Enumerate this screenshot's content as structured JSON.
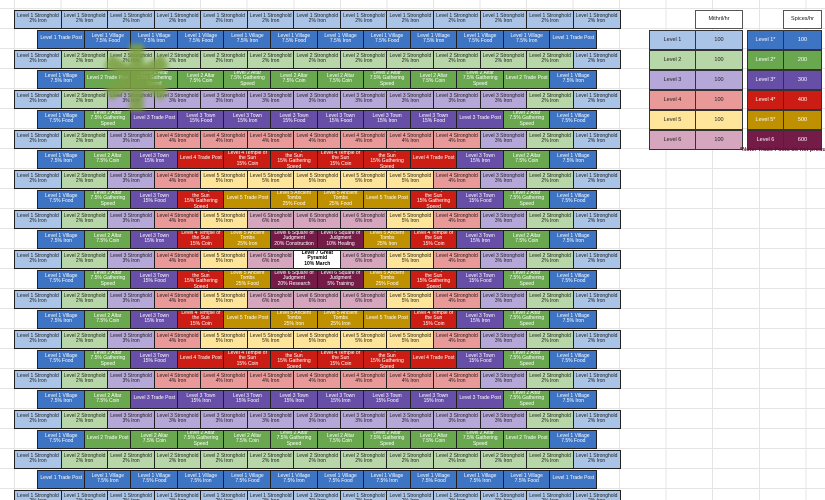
{
  "palette": {
    "light": {
      "1": "#a9c4e6",
      "2": "#b7d7a8",
      "3": "#b5a8d8",
      "4": "#ea9999",
      "5": "#ffe599",
      "6": "#d5a6bd"
    },
    "dark": {
      "1": "#3d74c4",
      "2": "#6aa84f",
      "3": "#674ea7",
      "4": "#cc1d14",
      "5": "#bf9000",
      "6": "#741b47"
    },
    "pyramid": "#ffffff",
    "border": "#202020",
    "gridline": "#e4e4e4"
  },
  "legend_left": {
    "header": "Mithril/hr",
    "rows": [
      {
        "label": "Level 1",
        "value": "100",
        "level": "1"
      },
      {
        "label": "Level 2",
        "value": "100",
        "level": "2"
      },
      {
        "label": "Level 3",
        "value": "100",
        "level": "3"
      },
      {
        "label": "Level 4",
        "value": "100",
        "level": "4"
      },
      {
        "label": "Level 5",
        "value": "100",
        "level": "5"
      },
      {
        "label": "Level 6",
        "value": "100",
        "level": "6"
      }
    ]
  },
  "legend_right": {
    "header": "Spices/hr",
    "rows": [
      {
        "label": "Level 1*",
        "value": "100",
        "level": "1"
      },
      {
        "label": "Level 2*",
        "value": "200",
        "level": "2"
      },
      {
        "label": "Level 3*",
        "value": "300",
        "level": "3"
      },
      {
        "label": "Level 4*",
        "value": "400",
        "level": "4"
      },
      {
        "label": "Level 5*",
        "value": "500",
        "level": "5"
      },
      {
        "label": "Level 6",
        "value": "600",
        "level": "6"
      }
    ]
  },
  "note": "*Note: Trade Posts do not produce",
  "marker": {
    "glyph": "✱",
    "color": "#7da045"
  },
  "map": {
    "rows": [
      {
        "cells": [
          "1|Level 1 Stronghold|2% Iron",
          "1|Level 1 Stronghold|2% Iron",
          "1|Level 1 Stronghold|2% Iron",
          "1|Level 1 Stronghold|2% Iron",
          "1|Level 1 Stronghold|2% Iron",
          "1|Level 1 Stronghold|2% Iron",
          "1|Level 1 Stronghold|2% Iron",
          "1|Level 1 Stronghold|2% Iron",
          "1|Level 1 Stronghold|2% Iron",
          "1|Level 1 Stronghold|2% Iron",
          "1|Level 1 Stronghold|2% Iron",
          "1|Level 1 Stronghold|2% Iron",
          "1|Level 1 Stronghold|2% Iron"
        ]
      },
      {
        "cells": [
          "1|Level 1 Trade Post",
          "1|Level 1 Village|7.5% Food",
          "1|Level 1 Village|7.5% Iron",
          "1|Level 1 Village|7.5% Food",
          "1|Level 1 Village|7.5% Iron",
          "1|Level 1 Village|7.5% Food",
          "1|Level 1 Village|7.5% Iron",
          "1|Level 1 Village|7.5% Food",
          "1|Level 1 Village|7.5% Iron",
          "1|Level 1 Village|7.5% Food",
          "1|Level 1 Village|7.5% Iron",
          "1|Level 1 Trade Post"
        ]
      },
      {
        "cells": [
          "1|Level 1 Stronghold|2% Iron",
          "2|Level 2 Stronghold|2% Iron",
          "2|Level 2 Stronghold|2% Iron",
          "2|Level 2 Stronghold|2% Iron",
          "2|Level 2 Stronghold|2% Iron",
          "2|Level 2 Stronghold|2% Iron",
          "2|Level 2 Stronghold|2% Iron",
          "2|Level 2 Stronghold|2% Iron",
          "2|Level 2 Stronghold|2% Iron",
          "2|Level 2 Stronghold|2% Iron",
          "2|Level 2 Stronghold|2% Iron",
          "2|Level 2 Stronghold|2% Iron",
          "1|Level 1 Stronghold|2% Iron"
        ]
      },
      {
        "cells": [
          "1|Level 1 Village|7.5% Iron",
          "2|Level 2 Trade Post",
          "2|Level 2 Altar|7.5% Gathering Speed",
          "2|Level 2 Altar|7.5% Coin",
          "2|Level 2 Altar|7.5% Gathering Speed",
          "2|Level 2 Altar|7.5% Coin",
          "2|Level 2 Altar|7.5% Coin",
          "2|Level 2 Altar|7.5% Gathering Speed",
          "2|Level 2 Altar|7.5% Coin",
          "2|Level 2 Altar|7.5% Gathering Speed",
          "2|Level 2 Trade Post",
          "1|Level 1 Village|7.5% Iron"
        ]
      },
      {
        "cells": [
          "1|Level 1 Stronghold|2% Iron",
          "2|Level 2 Stronghold|2% Iron",
          "3|Level 3 Stronghold|3% Iron",
          "3|Level 3 Stronghold|3% Iron",
          "3|Level 3 Stronghold|3% Iron",
          "3|Level 3 Stronghold|3% Iron",
          "3|Level 3 Stronghold|3% Iron",
          "3|Level 3 Stronghold|3% Iron",
          "3|Level 3 Stronghold|3% Iron",
          "3|Level 3 Stronghold|3% Iron",
          "3|Level 3 Stronghold|3% Iron",
          "2|Level 2 Stronghold|2% Iron",
          "1|Level 1 Stronghold|2% Iron"
        ]
      },
      {
        "cells": [
          "1|Level 1 Village|7.5% Food",
          "2|Level 2 Altar|7.5% Gathering Speed",
          "3|Level 3 Trade Post",
          "3|Level 3 Town|15% Food",
          "3|Level 3 Town|15% Iron",
          "3|Level 3 Town|15% Food",
          "3|Level 3 Town|15% Food",
          "3|Level 3 Town|15% Iron",
          "3|Level 3 Town|15% Food",
          "3|Level 3 Trade Post",
          "2|Level 2 Altar|7.5% Gathering Speed",
          "1|Level 1 Village|7.5% Food"
        ]
      },
      {
        "cells": [
          "1|Level 1 Stronghold|2% Iron",
          "2|Level 2 Stronghold|2% Iron",
          "3|Level 3 Stronghold|3% Iron",
          "4|Level 4 Stronghold|4% Iron",
          "4|Level 4 Stronghold|4% Iron",
          "4|Level 4 Stronghold|4% Iron",
          "4|Level 4 Stronghold|4% Iron",
          "4|Level 4 Stronghold|4% Iron",
          "4|Level 4 Stronghold|4% Iron",
          "4|Level 4 Stronghold|4% Iron",
          "3|Level 3 Stronghold|3% Iron",
          "2|Level 2 Stronghold|2% Iron",
          "1|Level 1 Stronghold|2% Iron"
        ]
      },
      {
        "cells": [
          "1|Level 1 Village|7.5% Iron",
          "2|Level 2 Altar|7.5% Coin",
          "3|Level 3 Town|15% Iron",
          "4|Level 4 Trade Post",
          "4|Level 4 Temple of the Sun|15% Coin",
          "4|Level 4 Temple of the Sun|15% Gathering Speed",
          "4|Level 4 Temple of the Sun|15% Coin",
          "4|Level 4 Temple of the Sun|15% Gathering Speed",
          "4|Level 4 Trade Post",
          "3|Level 3 Town|15% Iron",
          "2|Level 2 Altar|7.5% Coin",
          "1|Level 1 Village|7.5% Iron"
        ]
      },
      {
        "cells": [
          "1|Level 1 Stronghold|2% Iron",
          "2|Level 2 Stronghold|2% Iron",
          "3|Level 3 Stronghold|3% Iron",
          "4|Level 4 Stronghold|4% Iron",
          "5|Level 5 Stronghold|5% Iron",
          "5|Level 5 Stronghold|5% Iron",
          "5|Level 5 Stronghold|5% Iron",
          "5|Level 5 Stronghold|5% Iron",
          "5|Level 5 Stronghold|5% Iron",
          "4|Level 4 Stronghold|4% Iron",
          "3|Level 3 Stronghold|3% Iron",
          "2|Level 2 Stronghold|2% Iron",
          "1|Level 1 Stronghold|2% Iron"
        ]
      },
      {
        "cells": [
          "1|Level 1 Village|7.5% Food",
          "2|Level 2 Altar|7.5% Gathering Speed",
          "3|Level 3 Town|15% Food",
          "4|Level 4 Temple of the Sun|15% Gathering Speed",
          "5|Level 5 Trade Post",
          "5|Level 5 Ancient Tombs|25% Food",
          "5|Level 5 Ancient Tombs|25% Food",
          "5|Level 5 Trade Post",
          "4|Level 4 Temple of the Sun|15% Gathering Speed",
          "3|Level 3 Town|15% Food",
          "2|Level 2 Altar|7.5% Gathering Speed",
          "1|Level 1 Village|7.5% Food"
        ]
      },
      {
        "cells": [
          "1|Level 1 Stronghold|2% Iron",
          "2|Level 2 Stronghold|2% Iron",
          "3|Level 3 Stronghold|3% Iron",
          "4|Level 4 Stronghold|4% Iron",
          "5|Level 5 Stronghold|5% Iron",
          "6|Level 6 Stronghold|6% Iron",
          "6|Level 6 Stronghold|6% Iron",
          "6|Level 6 Stronghold|6% Iron",
          "5|Level 5 Stronghold|5% Iron",
          "4|Level 4 Stronghold|4% Iron",
          "3|Level 3 Stronghold|3% Iron",
          "2|Level 2 Stronghold|2% Iron",
          "1|Level 1 Stronghold|2% Iron"
        ]
      },
      {
        "cells": [
          "1|Level 1 Village|7.5% Iron",
          "2|Level 2 Altar|7.5% Coin",
          "3|Level 3 Town|15% Iron",
          "4|Level 4 Temple of the Sun|15% Coin",
          "5|Level 5 Ancient Tombs|25% Iron",
          "6|Level 6 Square of Judgment|20% Construction",
          "6|Level 6 Square of Judgment|10% Healing",
          "5|Level 5 Ancient Tombs|25% Iron",
          "4|Level 4 Temple of the Sun|15% Coin",
          "3|Level 3 Town|15% Iron",
          "2|Level 2 Altar|7.5% Coin",
          "1|Level 1 Village|7.5% Iron"
        ]
      },
      {
        "cells": [
          "1|Level 1 Stronghold|2% Iron",
          "2|Level 2 Stronghold|2% Iron",
          "3|Level 3 Stronghold|3% Iron",
          "4|Level 4 Stronghold|4% Iron",
          "5|Level 5 Stronghold|5% Iron",
          "6|Level 6 Stronghold|6% Iron",
          "7|Level 7 Great Pyramid|10% March",
          "6|Level 6 Stronghold|6% Iron",
          "5|Level 5 Stronghold|5% Iron",
          "4|Level 4 Stronghold|4% Iron",
          "3|Level 3 Stronghold|3% Iron",
          "2|Level 2 Stronghold|2% Iron",
          "1|Level 1 Stronghold|2% Iron"
        ]
      },
      {
        "cells": [
          "1|Level 1 Village|7.5% Food",
          "2|Level 2 Altar|7.5% Gathering Speed",
          "3|Level 3 Town|15% Food",
          "4|Level 4 Temple of the Sun|15% Gathering Speed",
          "5|Level 5 Ancient Tombs|25% Food",
          "6|Level 6 Square of Judgment|20% Research",
          "6|Level 6 Square of Judgment|5% Training",
          "5|Level 5 Ancient Tombs|25% Food",
          "4|Level 4 Temple of the Sun|15% Gathering Speed",
          "3|Level 3 Town|15% Food",
          "2|Level 2 Altar|7.5% Gathering Speed",
          "1|Level 1 Village|7.5% Food"
        ]
      },
      {
        "cells": [
          "1|Level 1 Stronghold|2% Iron",
          "2|Level 2 Stronghold|2% Iron",
          "3|Level 3 Stronghold|3% Iron",
          "4|Level 4 Stronghold|4% Iron",
          "5|Level 5 Stronghold|5% Iron",
          "6|Level 6 Stronghold|6% Iron",
          "6|Level 6 Stronghold|6% Iron",
          "6|Level 6 Stronghold|6% Iron",
          "5|Level 5 Stronghold|5% Iron",
          "4|Level 4 Stronghold|4% Iron",
          "3|Level 3 Stronghold|3% Iron",
          "2|Level 2 Stronghold|2% Iron",
          "1|Level 1 Stronghold|2% Iron"
        ]
      },
      {
        "cells": [
          "1|Level 1 Village|7.5% Iron",
          "2|Level 2 Altar|7.5% Coin",
          "3|Level 3 Town|15% Iron",
          "4|Level 4 Temple of the Sun|15% Coin",
          "5|Level 5 Trade Post",
          "5|Level 5 Ancient Tombs|25% Iron",
          "5|Level 5 Ancient Tombs|25% Iron",
          "5|Level 5 Trade Post",
          "4|Level 4 Temple of the Sun|15% Coin",
          "3|Level 3 Town|15% Iron",
          "2|Level 2 Altar|7.5% Gathering Speed",
          "1|Level 1 Village|7.5% Iron"
        ]
      },
      {
        "cells": [
          "1|Level 1 Stronghold|2% Iron",
          "2|Level 2 Stronghold|2% Iron",
          "3|Level 3 Stronghold|3% Iron",
          "4|Level 4 Stronghold|4% Iron",
          "5|Level 5 Stronghold|5% Iron",
          "5|Level 5 Stronghold|5% Iron",
          "5|Level 5 Stronghold|5% Iron",
          "5|Level 5 Stronghold|5% Iron",
          "5|Level 5 Stronghold|5% Iron",
          "4|Level 4 Stronghold|4% Iron",
          "3|Level 3 Stronghold|3% Iron",
          "2|Level 2 Stronghold|2% Iron",
          "1|Level 1 Stronghold|2% Iron"
        ]
      },
      {
        "cells": [
          "1|Level 1 Village|7.5% Food",
          "2|Level 2 Altar|7.5% Gathering Speed",
          "3|Level 3 Town|15% Food",
          "4|Level 4 Trade Post",
          "4|Level 4 Temple of the Sun|15% Coin",
          "4|Level 4 Temple of the Sun|15% Gathering Speed",
          "4|Level 4 Temple of the Sun|15% Coin",
          "4|Level 4 Temple of the Sun|15% Gathering Speed",
          "4|Level 4 Trade Post",
          "3|Level 3 Town|15% Food",
          "2|Level 2 Altar|7.5% Gathering Speed",
          "1|Level 1 Village|7.5% Food"
        ]
      },
      {
        "cells": [
          "1|Level 1 Stronghold|2% Iron",
          "2|Level 2 Stronghold|2% Iron",
          "3|Level 3 Stronghold|3% Iron",
          "4|Level 4 Stronghold|4% Iron",
          "4|Level 4 Stronghold|4% Iron",
          "4|Level 4 Stronghold|4% Iron",
          "4|Level 4 Stronghold|4% Iron",
          "4|Level 4 Stronghold|4% Iron",
          "4|Level 4 Stronghold|4% Iron",
          "4|Level 4 Stronghold|4% Iron",
          "3|Level 3 Stronghold|3% Iron",
          "2|Level 2 Stronghold|2% Iron",
          "1|Level 1 Stronghold|2% Iron"
        ]
      },
      {
        "cells": [
          "1|Level 1 Village|7.5% Iron",
          "2|Level 2 Altar|7.5% Coin",
          "3|Level 3 Trade Post",
          "3|Level 3 Town|15% Iron",
          "3|Level 3 Town|15% Food",
          "3|Level 3 Town|15% Iron",
          "3|Level 3 Town|15% Iron",
          "3|Level 3 Town|15% Food",
          "3|Level 3 Town|15% Iron",
          "3|Level 3 Trade Post",
          "2|Level 2 Altar|7.5% Gathering Speed",
          "1|Level 1 Village|7.5% Iron"
        ]
      },
      {
        "cells": [
          "1|Level 1 Stronghold|2% Iron",
          "2|Level 2 Stronghold|2% Iron",
          "3|Level 3 Stronghold|3% Iron",
          "3|Level 3 Stronghold|3% Iron",
          "3|Level 3 Stronghold|3% Iron",
          "3|Level 3 Stronghold|3% Iron",
          "3|Level 3 Stronghold|3% Iron",
          "3|Level 3 Stronghold|3% Iron",
          "3|Level 3 Stronghold|3% Iron",
          "3|Level 3 Stronghold|3% Iron",
          "3|Level 3 Stronghold|3% Iron",
          "2|Level 2 Stronghold|2% Iron",
          "1|Level 1 Stronghold|2% Iron"
        ]
      },
      {
        "cells": [
          "1|Level 1 Village|7.5% Food",
          "2|Level 2 Trade Post",
          "2|Level 2 Altar|7.5% Coin",
          "2|Level 2 Altar|7.5% Gathering Speed",
          "2|Level 2 Altar|7.5% Coin",
          "2|Level 2 Altar|7.5% Gathering Speed",
          "2|Level 2 Altar|7.5% Coin",
          "2|Level 2 Altar|7.5% Gathering Speed",
          "2|Level 2 Altar|7.5% Coin",
          "2|Level 2 Altar|7.5% Gathering Speed",
          "2|Level 2 Trade Post",
          "1|Level 1 Village|7.5% Food"
        ]
      },
      {
        "cells": [
          "1|Level 1 Stronghold|2% Iron",
          "2|Level 2 Stronghold|2% Iron",
          "2|Level 2 Stronghold|2% Iron",
          "2|Level 2 Stronghold|2% Iron",
          "2|Level 2 Stronghold|2% Iron",
          "2|Level 2 Stronghold|2% Iron",
          "2|Level 2 Stronghold|2% Iron",
          "2|Level 2 Stronghold|2% Iron",
          "2|Level 2 Stronghold|2% Iron",
          "2|Level 2 Stronghold|2% Iron",
          "2|Level 2 Stronghold|2% Iron",
          "2|Level 2 Stronghold|2% Iron",
          "1|Level 1 Stronghold|2% Iron"
        ]
      },
      {
        "cells": [
          "1|Level 1 Trade Post",
          "1|Level 1 Village|7.5% Iron",
          "1|Level 1 Village|7.5% Food",
          "1|Level 1 Village|7.5% Iron",
          "1|Level 1 Village|7.5% Food",
          "1|Level 1 Village|7.5% Iron",
          "1|Level 1 Village|7.5% Food",
          "1|Level 1 Village|7.5% Iron",
          "1|Level 1 Village|7.5% Food",
          "1|Level 1 Village|7.5% Iron",
          "1|Level 1 Village|7.5% Food",
          "1|Level 1 Trade Post"
        ]
      },
      {
        "cells": [
          "1|Level 1 Stronghold|2% Iron",
          "1|Level 1 Stronghold|2% Iron",
          "1|Level 1 Stronghold|2% Iron",
          "1|Level 1 Stronghold|2% Iron",
          "1|Level 1 Stronghold|2% Iron",
          "1|Level 1 Stronghold|2% Iron",
          "1|Level 1 Stronghold|2% Iron",
          "1|Level 1 Stronghold|2% Iron",
          "1|Level 1 Stronghold|2% Iron",
          "1|Level 1 Stronghold|2% Iron",
          "1|Level 1 Stronghold|2% Iron",
          "1|Level 1 Stronghold|2% Iron",
          "1|Level 1 Stronghold|2% Iron"
        ]
      }
    ]
  }
}
